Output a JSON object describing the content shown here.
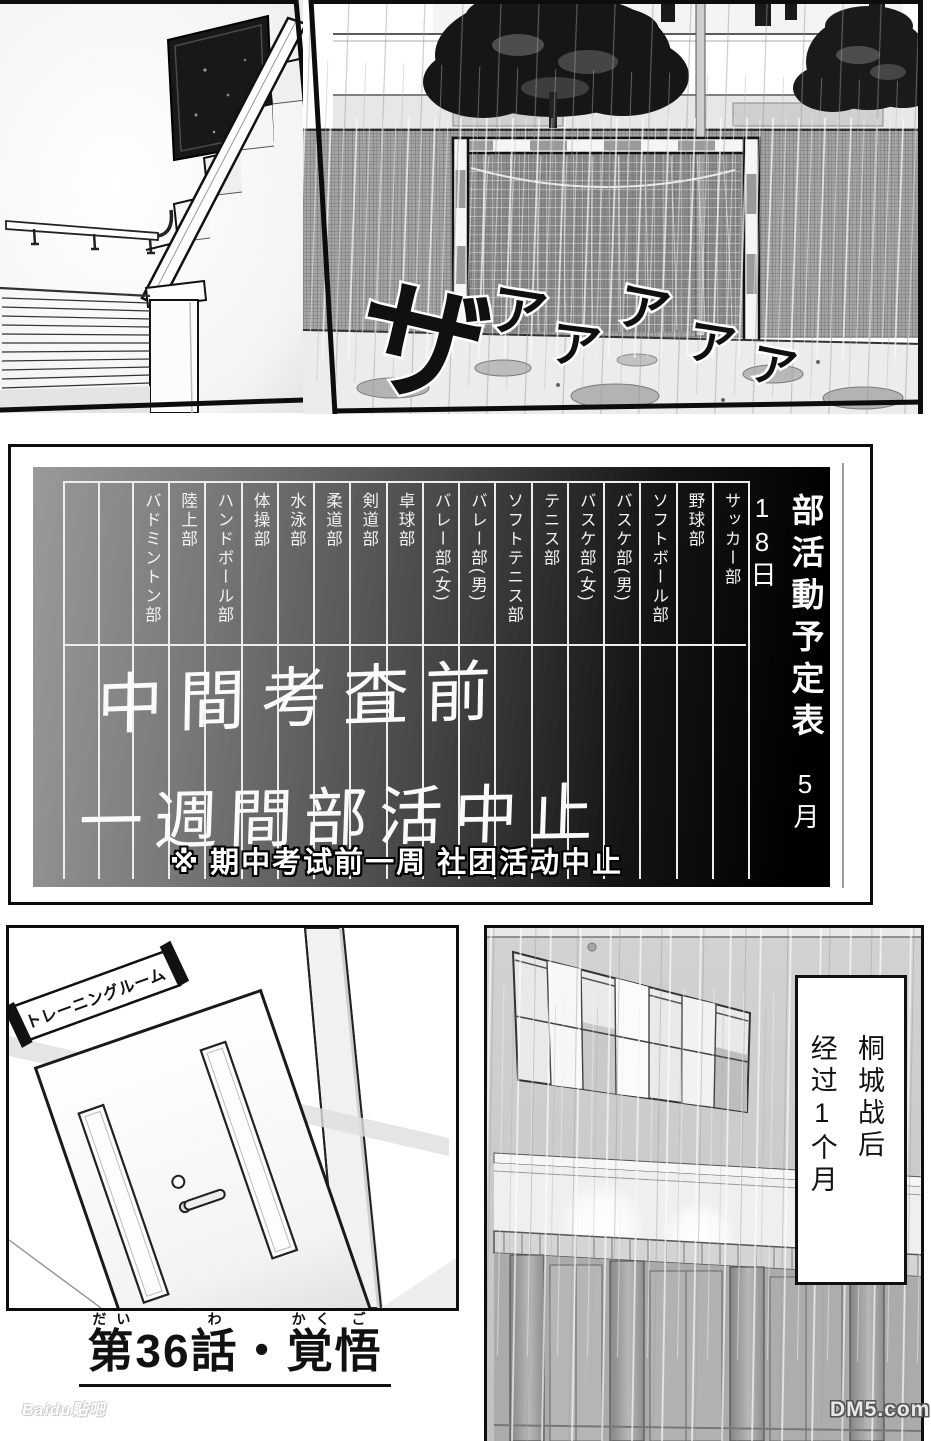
{
  "top_right_panel": {
    "sfx_text": "ザアアアアア",
    "sfx_chars": [
      "ザ",
      "ア",
      "ア",
      "ア",
      "ア",
      "ア"
    ]
  },
  "board": {
    "title": "部活動予定表",
    "date": "5月18日",
    "clubs": [
      "サッカー部",
      "野球部",
      "ソフトボール部",
      "バスケ部(男)",
      "バスケ部(女)",
      "テニス部",
      "ソフトテニス部",
      "バレー部(男)",
      "バレー部(女)",
      "卓球部",
      "剣道部",
      "柔道部",
      "水泳部",
      "体操部",
      "ハンドボール部",
      "陸上部",
      "バドミントン部"
    ],
    "handwriting_line1": "中間考査前",
    "handwriting_line2": "一週間部活中止",
    "translator_note": "※ 期中考试前一周 社团活动中止"
  },
  "training_room": {
    "door_sign": "トレーニングルーム"
  },
  "narration": {
    "line1": "桐城战后",
    "line2": "经过1个月"
  },
  "chapter_title": {
    "full": "第36話・覚悟",
    "dai": "第",
    "dai_ruby": "だい",
    "number": "36",
    "wa": "話",
    "wa_ruby": "わ",
    "dot": "・",
    "kaku": "覚",
    "kaku_ruby": "かく",
    "go": "悟",
    "go_ruby": "ご"
  },
  "watermarks": {
    "bottom_left": "Baidu贴吧",
    "bottom_right": "DM5.com"
  }
}
